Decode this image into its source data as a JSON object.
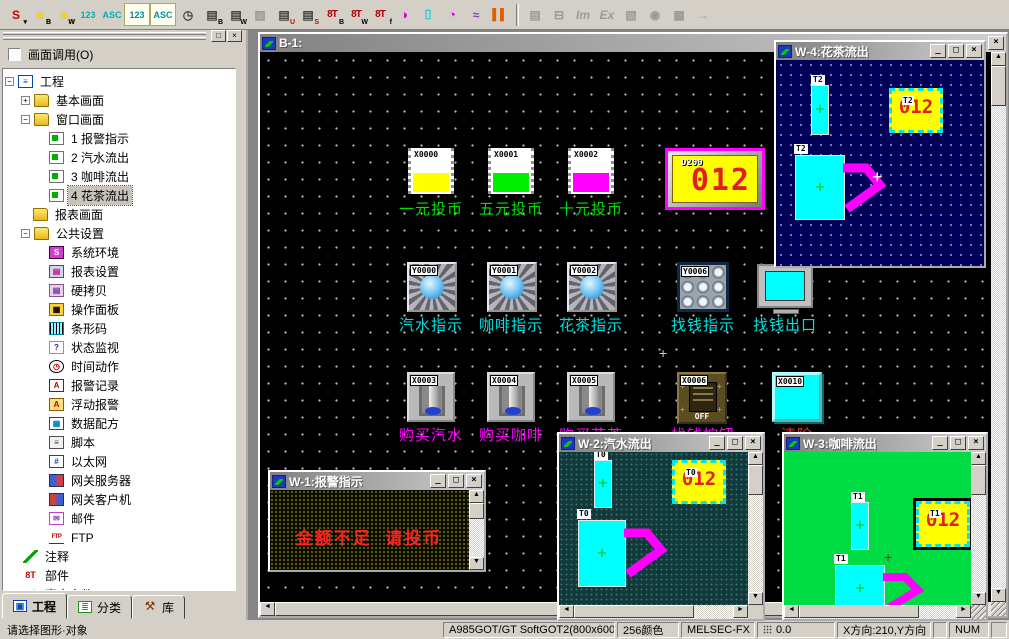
{
  "palette": {
    "chrome": "#d4d0c8",
    "canvas_black": "#000000",
    "w1_bg": "#0c0c00",
    "w2_bg": "#12383a",
    "w3_bg": "#00dd44",
    "w4_bg": "#000058",
    "display_yellow": "#ffff00",
    "value_red": "#e02020",
    "label_green": "#00e000",
    "label_cyan": "#00e0e0",
    "label_magenta": "#ff00ff",
    "handle_magenta": "#ff00ff"
  },
  "chrome": {
    "minimize": "_",
    "maximize": "□",
    "close": "×",
    "up": "▲",
    "down": "▼",
    "left": "◄",
    "right": "►"
  },
  "toolbar": {
    "group1": [
      {
        "name": "s-mode-dropdown",
        "glyph": "S",
        "sub": "▾"
      },
      {
        "name": "bit-lamp",
        "glyph": "●",
        "sub": "B"
      },
      {
        "name": "word-lamp",
        "glyph": "●",
        "sub": "W"
      },
      {
        "name": "numeric-display",
        "glyph": "123"
      },
      {
        "name": "ascii-display",
        "glyph": "ASC"
      },
      {
        "name": "numeric-input",
        "glyph": "123"
      },
      {
        "name": "ascii-input",
        "glyph": "ASC"
      },
      {
        "name": "clock-display",
        "glyph": "◷"
      },
      {
        "name": "bit-comment",
        "glyph": "▤",
        "sub": "B"
      },
      {
        "name": "word-comment",
        "glyph": "▤",
        "sub": "W"
      },
      {
        "name": "parts-display",
        "glyph": "▨"
      },
      {
        "name": "user-alarm",
        "glyph": "▤",
        "sub": "U"
      },
      {
        "name": "system-alarm",
        "glyph": "▤",
        "sub": "S"
      },
      {
        "name": "alarm-history-bit",
        "glyph": "8T",
        "sub": "B"
      },
      {
        "name": "alarm-history-word",
        "glyph": "8T",
        "sub": "W"
      },
      {
        "name": "alarm-history-float",
        "glyph": "8T",
        "sub": "f"
      },
      {
        "name": "pie-graph",
        "glyph": "◑"
      },
      {
        "name": "level-display",
        "glyph": "⌷"
      },
      {
        "name": "panel-meter",
        "glyph": "◔"
      },
      {
        "name": "trend-graph",
        "glyph": "≈"
      },
      {
        "name": "bar-graph",
        "glyph": "▌▌"
      }
    ],
    "group2": [
      {
        "name": "new-screen",
        "glyph": "▤"
      },
      {
        "name": "outline-view",
        "glyph": "⊟"
      },
      {
        "name": "import",
        "glyph": "Im"
      },
      {
        "name": "export",
        "glyph": "Ex"
      },
      {
        "name": "screen-image",
        "glyph": "▧"
      },
      {
        "name": "find",
        "glyph": "◉"
      },
      {
        "name": "fill-pattern",
        "glyph": "▦"
      },
      {
        "name": "next-window",
        "glyph": "→"
      }
    ]
  },
  "sidebar": {
    "screen_call_label": "画面调用(O)",
    "tree": [
      {
        "icon": "project",
        "label": "工程"
      },
      {
        "icon": "folder",
        "label": "基本画面"
      },
      {
        "icon": "folder",
        "label": "窗口画面"
      },
      {
        "icon": "screen",
        "label": "1 报警指示"
      },
      {
        "icon": "screen",
        "label": "2 汽水流出"
      },
      {
        "icon": "screen",
        "label": "3 咖啡流出"
      },
      {
        "icon": "screen",
        "label": "4 花茶流出"
      },
      {
        "icon": "folder",
        "label": "报表画面"
      },
      {
        "icon": "folder",
        "label": "公共设置"
      },
      {
        "icon": "system-env",
        "label": "系统环境"
      },
      {
        "icon": "report-settings",
        "label": "报表设置"
      },
      {
        "icon": "hardcopy",
        "label": "硬拷贝"
      },
      {
        "icon": "operation-panel",
        "label": "操作面板"
      },
      {
        "icon": "barcode",
        "label": "条形码"
      },
      {
        "icon": "status-watch",
        "label": "状态监视"
      },
      {
        "icon": "time-action",
        "label": "时间动作"
      },
      {
        "icon": "alarm-record",
        "label": "报警记录"
      },
      {
        "icon": "float-alarm",
        "label": "浮动报警"
      },
      {
        "icon": "data-recipe",
        "label": "数据配方"
      },
      {
        "icon": "script",
        "label": "脚本"
      },
      {
        "icon": "ethernet",
        "label": "以太网"
      },
      {
        "icon": "gateway-server",
        "label": "网关服务器"
      },
      {
        "icon": "gateway-client",
        "label": "网关客户机"
      },
      {
        "icon": "mail",
        "label": "邮件"
      },
      {
        "icon": "ftp",
        "label": "FTP"
      },
      {
        "icon": "comment",
        "label": "注释"
      },
      {
        "icon": "parts",
        "label": "部件"
      },
      {
        "icon": "sound-file",
        "label": "声音文件"
      }
    ],
    "tabs": [
      {
        "label": "工程"
      },
      {
        "label": "分类"
      },
      {
        "label": "库"
      }
    ]
  },
  "statusbar": {
    "hint": "请选择图形·对象",
    "gt_type": "A985GOT/GT SoftGOT2(800x600)",
    "colors": "256颜色",
    "plc_type": "MELSEC-FX",
    "grid_value": "0.0",
    "direction": "X方向:210,Y方向",
    "num_lock": "NUM"
  },
  "mdi": {
    "b1": {
      "title": "B-1:",
      "coin_buttons": [
        {
          "tag": "X0000",
          "color": "#ffff00",
          "label": "一元投币"
        },
        {
          "tag": "X0001",
          "color": "#00ee00",
          "label": "五元投币"
        },
        {
          "tag": "X0002",
          "color": "#ff00ff",
          "label": "十元投币"
        }
      ],
      "display": {
        "tag": "D200",
        "value": "012"
      },
      "lamps": [
        {
          "tag": "Y0000",
          "label": "汽水指示"
        },
        {
          "tag": "Y0001",
          "label": "咖啡指示"
        },
        {
          "tag": "Y0002",
          "label": "花茶指示"
        },
        {
          "tag": "Y0006",
          "label": "找钱指示"
        }
      ],
      "outlet_label": "找钱出口",
      "switches": [
        {
          "tag": "X0003",
          "label": "购买汽水"
        },
        {
          "tag": "X0004",
          "label": "购买咖啡"
        },
        {
          "tag": "X0005",
          "label": "购买花茶"
        }
      ],
      "off_switch": {
        "tag": "X0006",
        "label": "找钱按钮",
        "state": "OFF"
      },
      "clear_button": {
        "tag": "X0010",
        "label": "清除"
      }
    },
    "w1": {
      "title": "W-1:报警指示",
      "message": "金额不足  请投币"
    },
    "w2": {
      "title": "W-2:汽水流出",
      "tag": "T0",
      "value": "012"
    },
    "w3": {
      "title": "W-3:咖啡流出",
      "tag": "T1",
      "value": "012"
    },
    "w4": {
      "title": "W-4:花茶流出",
      "tag": "T2",
      "value": "012"
    }
  }
}
